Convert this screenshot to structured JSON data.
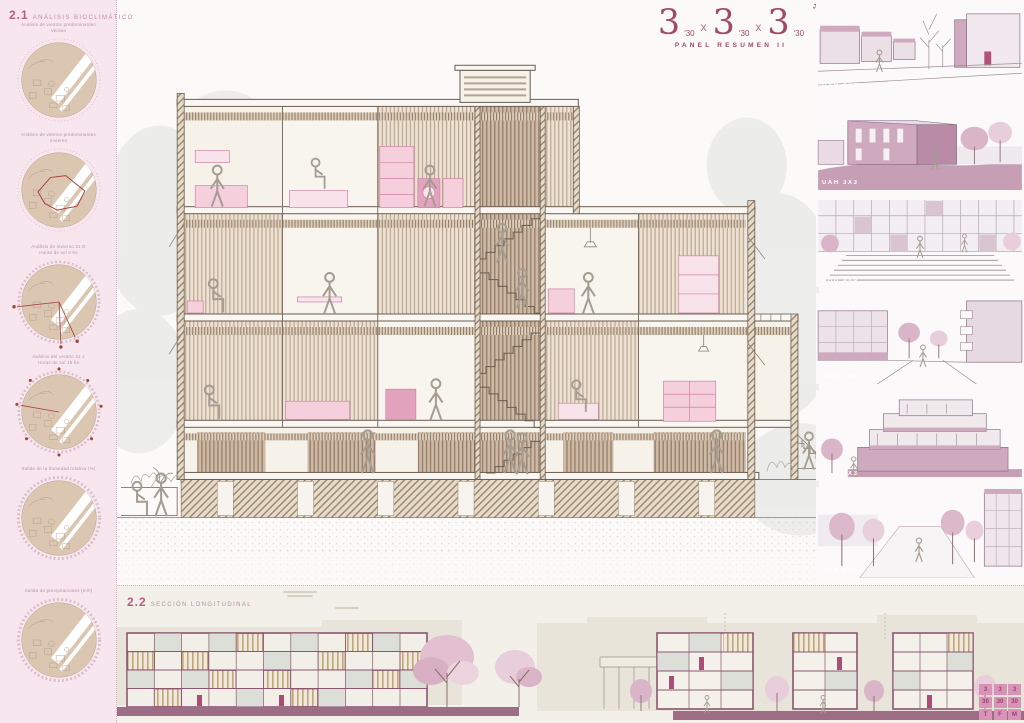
{
  "sections": {
    "s21": {
      "number": "2.1",
      "title": "ANÁLISIS BIOCLIMÁTICO"
    },
    "s22": {
      "number": "2.2",
      "title": "SECCIÓN LONGITUDINAL"
    }
  },
  "logo": {
    "digit": "3",
    "sub": "'30",
    "times": "x",
    "plane_glyph": "✈",
    "subtitle": "PANEL RESUMEN II"
  },
  "sidebar": {
    "diagrams": [
      {
        "line1": "Análisis de vientos predominantes",
        "line2": "Verano"
      },
      {
        "line1": "Análisis de vientos predominantes",
        "line2": "Invierno"
      },
      {
        "line1": "Análisis de invierno 21 D",
        "line2": "Horas de sol 8 hs"
      },
      {
        "line1": "Análisis del verano 21 J",
        "line2": "Horas de sol 15 hs"
      },
      {
        "line1": "Salida de la humedad relativa (%)",
        "line2": ""
      },
      {
        "line1": "Salida de precipitaciones (mm)",
        "line2": ""
      }
    ]
  },
  "renders": {
    "watermark": "UAH 3X3"
  },
  "corner_logo": {
    "rows": [
      [
        "3",
        "3",
        "3"
      ],
      [
        "30",
        "30",
        "30"
      ],
      [
        "T",
        "F",
        "M"
      ]
    ]
  },
  "palette": {
    "accent_maroon": "#a04a66",
    "pink_background": "#f7e6ee",
    "plum_elevation": "#8a5670",
    "slat_tan": "#c9ad7c",
    "wall_tan": "#cdb9a4",
    "furniture_pink": "#f5cfdc"
  }
}
